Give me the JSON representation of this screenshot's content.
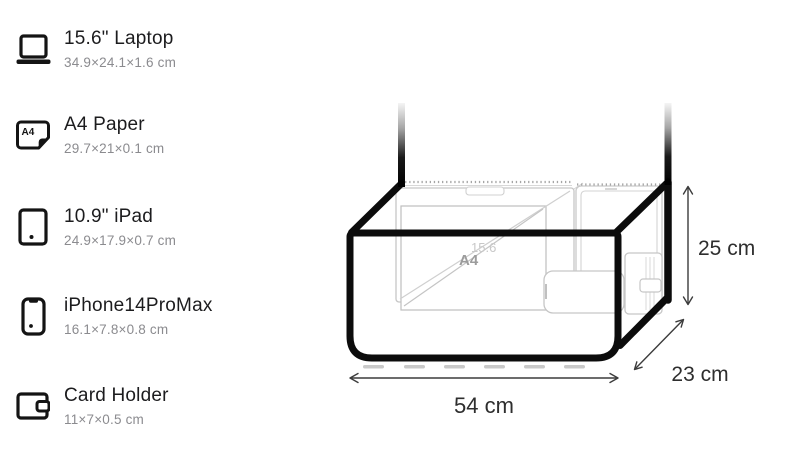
{
  "items": [
    {
      "name": "15.6\" Laptop",
      "dims": "34.9×24.1×1.6 cm",
      "icon": "laptop-icon"
    },
    {
      "name": "A4 Paper",
      "dims": "29.7×21×0.1 cm",
      "icon": "a4-paper-icon",
      "icon_label": "A4"
    },
    {
      "name": "10.9\" iPad",
      "dims": "24.9×17.9×0.7 cm",
      "icon": "ipad-icon"
    },
    {
      "name": "iPhone14ProMax",
      "dims": "16.1×7.8×0.8 cm",
      "icon": "iphone-icon"
    },
    {
      "name": "Card Holder",
      "dims": "11×7×0.5 cm",
      "icon": "card-holder-icon"
    }
  ],
  "diagram": {
    "width_label": "54 cm",
    "depth_label": "23 cm",
    "height_label": "25 cm",
    "interior": {
      "a4_label": "A4",
      "laptop_label": "15.6"
    }
  },
  "colors": {
    "bag_outline": "#0c0c0c",
    "item_title": "#1c1c1e",
    "item_dims": "#8b8b8f",
    "interior_lines": "#c6c6c6",
    "dimension_lines": "#3c3c3c",
    "dimension_text": "#2e2e2e"
  }
}
